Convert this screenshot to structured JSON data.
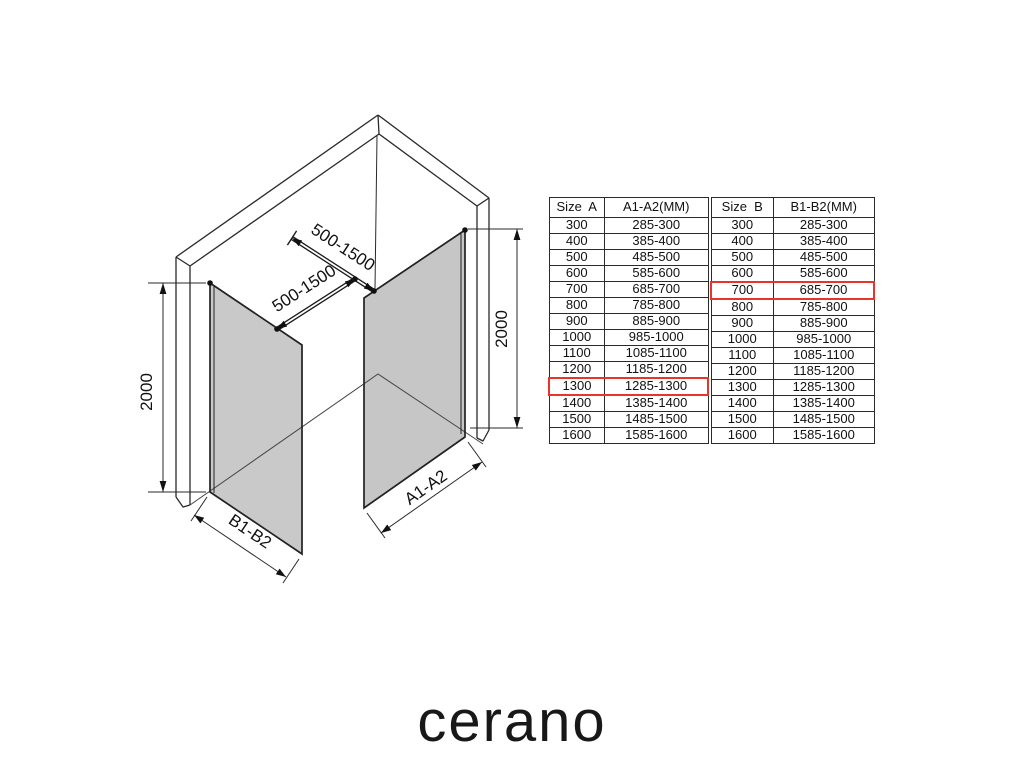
{
  "brand": {
    "logo": "cerano"
  },
  "colors": {
    "highlight": "#e8352a",
    "line": "#2a2a2a",
    "glass": "#c9c9c9"
  },
  "diagram": {
    "labels": {
      "bar_a_length": "500-1500",
      "bar_b_length": "500-1500",
      "height_left": "2000",
      "height_right": "2000",
      "panel_b_width": "B1-B2",
      "panel_a_width": "A1-A2"
    }
  },
  "tables": {
    "size_a": {
      "headers": [
        "Size  A",
        "A1-A2(MM)"
      ],
      "rows": [
        [
          "300",
          "285-300"
        ],
        [
          "400",
          "385-400"
        ],
        [
          "500",
          "485-500"
        ],
        [
          "600",
          "585-600"
        ],
        [
          "700",
          "685-700"
        ],
        [
          "800",
          "785-800"
        ],
        [
          "900",
          "885-900"
        ],
        [
          "1000",
          "985-1000"
        ],
        [
          "1100",
          "1085-1100"
        ],
        [
          "1200",
          "1185-1200"
        ],
        [
          "1300",
          "1285-1300"
        ],
        [
          "1400",
          "1385-1400"
        ],
        [
          "1500",
          "1485-1500"
        ],
        [
          "1600",
          "1585-1600"
        ]
      ],
      "highlight_row": 10
    },
    "size_b": {
      "headers": [
        "Size  B",
        "B1-B2(MM)"
      ],
      "rows": [
        [
          "300",
          "285-300"
        ],
        [
          "400",
          "385-400"
        ],
        [
          "500",
          "485-500"
        ],
        [
          "600",
          "585-600"
        ],
        [
          "700",
          "685-700"
        ],
        [
          "800",
          "785-800"
        ],
        [
          "900",
          "885-900"
        ],
        [
          "1000",
          "985-1000"
        ],
        [
          "1100",
          "1085-1100"
        ],
        [
          "1200",
          "1185-1200"
        ],
        [
          "1300",
          "1285-1300"
        ],
        [
          "1400",
          "1385-1400"
        ],
        [
          "1500",
          "1485-1500"
        ],
        [
          "1600",
          "1585-1600"
        ]
      ],
      "highlight_row": 4
    }
  }
}
